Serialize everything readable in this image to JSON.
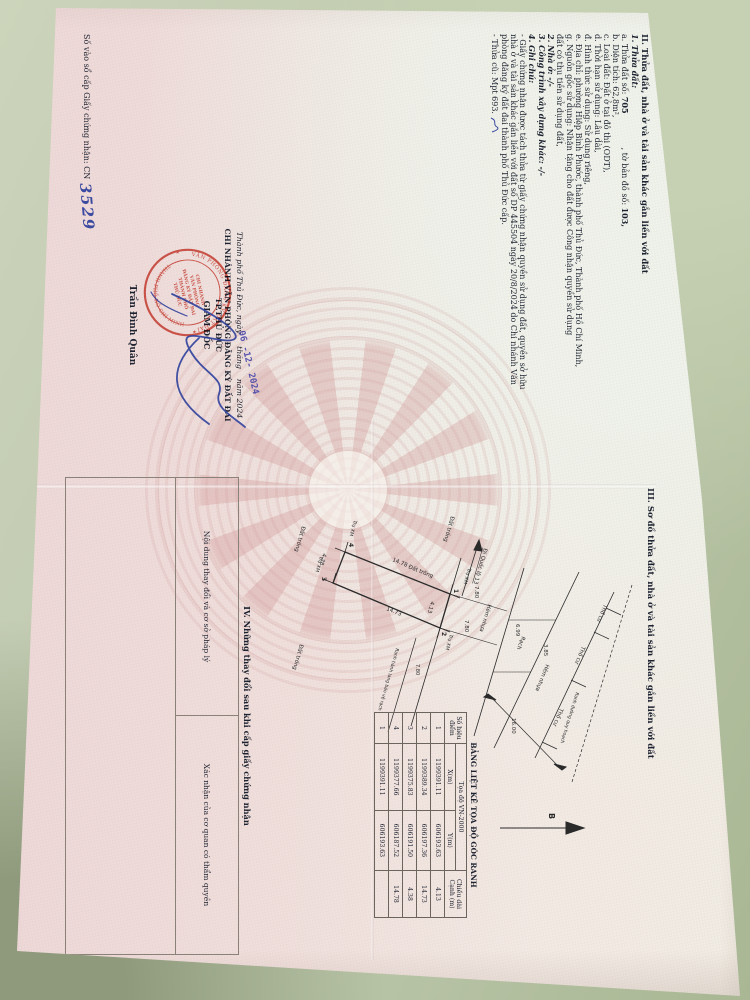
{
  "registry": {
    "label": "Số vào sổ cấp Giấy chứng nhận: CN",
    "number": "3529"
  },
  "section2": {
    "heading": "II. Thửa đất, nhà ở và tài sản khác gắn liền với đất",
    "sub1": "1. Thửa đất:",
    "a_label": "a. Thửa đất số:",
    "a_value": "705",
    "a_mid": ", tờ bản đồ số:",
    "a_value2": "103,",
    "b": "b. Diện tích: 62,8m²,",
    "c": "c. Loại đất: Đất ở tại đô thị (ODT),",
    "d": "d. Thời hạn sử dụng: Lâu dài,",
    "dd": "đ. Hình thức sử dụng: Sử dụng riêng,",
    "e": "e. Địa chỉ: phường Hiệp Bình Phước, thành phố Thủ Đức, Thành phố Hồ Chí Minh,",
    "g1": "g. Nguồn gốc sử dụng: Nhận tặng cho đất được Công nhận quyền sử dụng",
    "g2": "đất có thu tiền sử dụng đất,",
    "item2": "2. Nhà ở: -/-",
    "item3": "3. Công trình xây dựng khác: -/-",
    "item4": "4. Ghi chú:",
    "note1": "- Giấy chứng nhận được tách thửa từ giấy chứng nhận quyền sử dụng đất, quyền sở hữu",
    "note2": "nhà ở và tài sản khác gắn liền với đất số DP 445504 ngày 20/8/2024 do Chi nhánh Văn",
    "note3": "phòng đăng ký đất đai thành phố Thủ Đức cấp.",
    "note4": "- Thửa cũ: Mpt 693."
  },
  "section3": {
    "heading": "III. Sơ đồ thửa đất, nhà ở và tài sản khác gắn liền với đất"
  },
  "diagram": {
    "labels": {
      "dat_trong": "Đất trống",
      "tru_xm": "Trụ XM",
      "hem_nhua": "Hẻm nhựa",
      "rach": "Rạch",
      "tho_cu": "Thổ cư",
      "di_quoc_lo": "Đi Quốc lộ 13",
      "ranh_duong": "Ranh đường quy hoạch",
      "ranh_hanh_lang": "Ranh hành lang bảo vệ rạch"
    },
    "dims": {
      "side41": "14.78",
      "side23": "14.73",
      "side12": "4.13",
      "side34": "4.38",
      "alley_a": "7.80",
      "alley_b": "7.80",
      "corridor": "7.80",
      "canal_a": "6.99",
      "canal_b": "3.85",
      "frontage": "16.00"
    },
    "points": {
      "p1": "1",
      "p2": "2",
      "p3": "3",
      "p4": "4"
    },
    "north": "B"
  },
  "coord_table": {
    "title": "BẢNG LIỆT KÊ TỌA ĐỘ GÓC RANH",
    "col_point": "Số hiệu điểm",
    "col_coord": "Tọa độ VN-2000",
    "col_x": "X(m)",
    "col_y": "Y(m)",
    "col_len1": "Chiều dài",
    "col_len2": "Cạnh (m)",
    "rows": [
      [
        "1",
        "1199391.11",
        "606193.63",
        "4.13"
      ],
      [
        "2",
        "1199389.34",
        "606197.36",
        "14.73"
      ],
      [
        "3",
        "1199375.83",
        "606191.50",
        "4.38"
      ],
      [
        "4",
        "1199377.66",
        "606187.52",
        "14.78"
      ],
      [
        "1",
        "1199391.11",
        "606193.63",
        ""
      ]
    ]
  },
  "section4": {
    "title": "IV. Những thay đổi sau khi cấp giấy chứng nhận",
    "col_left": "Nội dung thay đổi và cơ sở pháp lý",
    "col_right": "Xác nhận của cơ quan có thẩm quyền"
  },
  "signature": {
    "place_date": "Thành phố Thủ Đức, ngày     tháng    năm 2024",
    "office": "CHI NHÁNH VĂN PHÒNG ĐĂNG KÝ ĐẤT ĐAI TP.THỦ ĐỨC",
    "role": "GIÁM ĐỐC",
    "name": "Trần Đình Quân",
    "date_stamp": "06 -12- 2024"
  },
  "stamp": {
    "rim_top": "VĂN PHÒNG ĐĂNG KÝ ĐẤT ĐAI",
    "rim_bottom": "THÀNH PHỐ HỒ CHÍ MINH",
    "star": "★",
    "center": [
      "CHI NHÁNH",
      "VĂN PHÒNG",
      "ĐĂNG KÝ ĐẤT ĐAI",
      "THÀNH PHỐ",
      "THỦ ĐỨC"
    ]
  }
}
